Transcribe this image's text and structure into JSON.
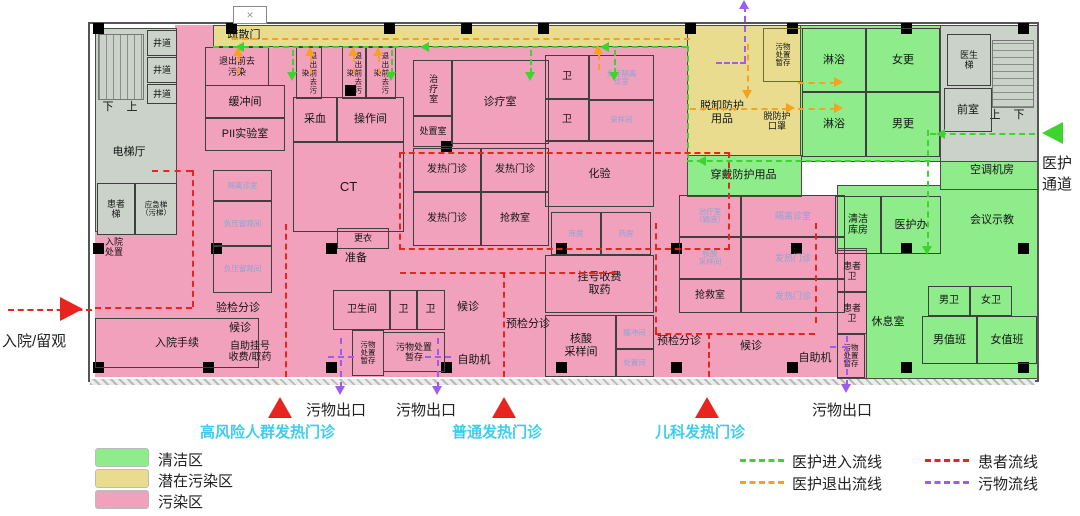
{
  "colors": {
    "clean_zone": "#8eec8b",
    "potential_zone": "#eadc8f",
    "contaminated_zone": "#f2a1bc",
    "gray_core": "#cbd2ca",
    "staff_in_flow": "#3ed32e",
    "staff_out_flow": "#f5a21f",
    "patient_flow": "#e8241f",
    "waste_flow": "#9c5cf0",
    "entrance_text": "#3ecdef",
    "special_room_text": "#8ca3d8"
  },
  "rooms": {
    "shaft": "井道",
    "down": "下",
    "up": "上",
    "elevator_hall": "电梯厅",
    "patient_lift": "患者\n梯",
    "emergency_lift": "应急梯\n（污梯）",
    "admission_disposal": "入院\n处置",
    "admission_procedure": "入院手续",
    "evac_door": "疏散门",
    "decon_h": "退出前去\n污染",
    "decon_v": "退出前去污染",
    "buffer": "缓冲间",
    "pii_lab": "PII实验室",
    "blood_draw": "采血",
    "operation": "操作间",
    "ct": "CT",
    "iso_clinic": "隔离诊室",
    "iso_obs": "负压留观间",
    "triage_check": "验检分诊",
    "waiting": "候诊",
    "self_reg": "自助挂号\n收费/取药",
    "changing": "更衣",
    "prep": "准备",
    "toilet_room": "卫生间",
    "toilet": "卫",
    "waste_store": "污物处置\n暂存",
    "waste_store_v": "污物\n处置\n暂存",
    "self_machine": "自助机",
    "treatment": "治疗室",
    "disposal_room": "处置室",
    "consult": "诊疗室",
    "fever_clinic": "发热门诊",
    "rescue": "抢救室",
    "lab": "化验",
    "neg_iso_clinic": "负压隔离\n诊室",
    "sample_room": "采样间",
    "store": "库房",
    "pharmacy": "药房",
    "registration": "挂号收费\n取药",
    "nucleic": "核酸\n采样间",
    "buffer_small": "缓冲间",
    "disposal_small": "处置间",
    "pre_triage": "预检分诊",
    "ped_infusion": "治疗室\n（输液）",
    "don_ppe": "穿戴防护用品",
    "doff_ppe": "脱卸防护\n用品",
    "doff_mask": "脱防护\n口罩",
    "shower": "淋浴",
    "female_change": "女更",
    "male_change": "男更",
    "clean_store": "清洁\n库房",
    "staff_office": "医护办",
    "patient_toilet": "患者\n卫",
    "rest_room": "休息室",
    "male_toilet": "男卫",
    "female_toilet": "女卫",
    "male_duty": "男值班",
    "female_duty": "女值班",
    "ac_room": "空调机房",
    "meeting": "会议示教",
    "doctor_lift": "医生\n梯",
    "front_room": "前室"
  },
  "external": {
    "admission": "入院/留观",
    "staff_channel": "医护\n通道",
    "waste_exit": "污物出口",
    "entrance_high_risk": "高风险人群发热门诊",
    "entrance_general": "普通发热门诊",
    "entrance_pediatric": "儿科发热门诊"
  },
  "legend": {
    "areas": [
      {
        "label": "清洁区",
        "color": "#8eec8b"
      },
      {
        "label": "潜在污染区",
        "color": "#eadc8f"
      },
      {
        "label": "污染区",
        "color": "#f2a1bc"
      }
    ],
    "flows": [
      {
        "label": "医护进入流线",
        "color": "#3ed32e"
      },
      {
        "label": "医护退出流线",
        "color": "#f5a21f"
      },
      {
        "label": "患者流线",
        "color": "#e8241f"
      },
      {
        "label": "污物流线",
        "color": "#9c5cf0"
      }
    ]
  }
}
